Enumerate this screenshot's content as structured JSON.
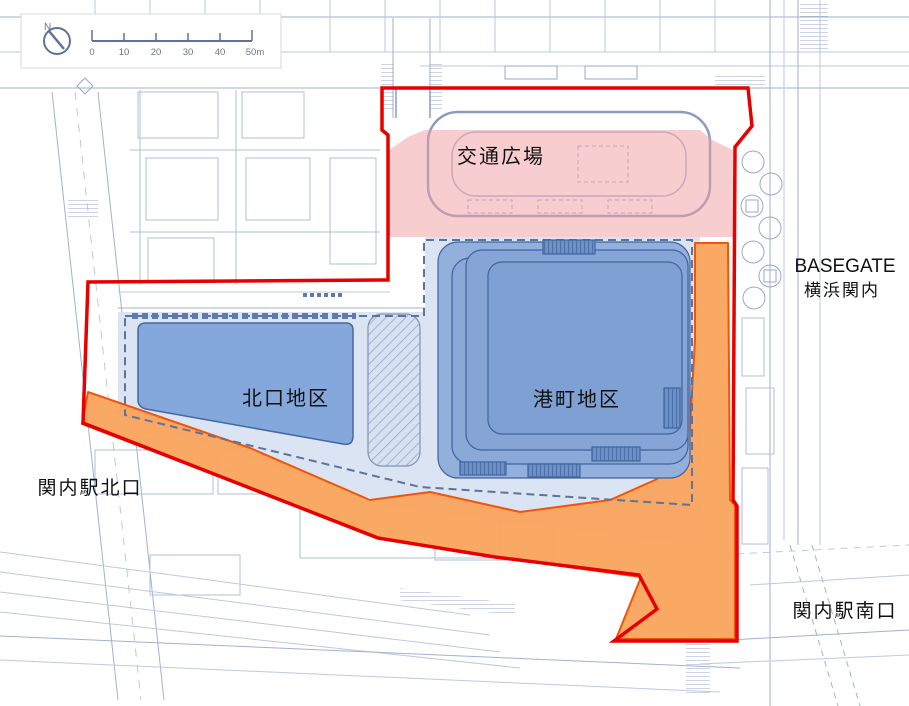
{
  "map": {
    "areas": {
      "traffic_plaza": {
        "label": "交通広場"
      },
      "north_exit": {
        "label": "北口地区"
      },
      "minatomachi": {
        "label": "港町地区"
      }
    },
    "labels": {
      "basegate_line1": "BASEGATE",
      "basegate_line2": "横浜関内",
      "kannai_north": "関内駅北口",
      "kannai_south": "関内駅南口"
    },
    "scale_bar": {
      "north_label": "N",
      "ticks": [
        "0",
        "10",
        "20",
        "30",
        "40",
        "50m"
      ]
    },
    "colors": {
      "boundary_red": "#E60000",
      "plaza_pink": "#F29BA2",
      "orange_fill": "#FAA45C",
      "orange_edge": "#F4540A",
      "district_blue": "#84A8DC",
      "district_border": "#44699F",
      "building_blue": "#7EA0D3",
      "site_bg_blue": "#DBE4F2",
      "dashed_border": "#5D7399",
      "map_line": "#8C9EC2",
      "text_black": "#111111"
    }
  }
}
